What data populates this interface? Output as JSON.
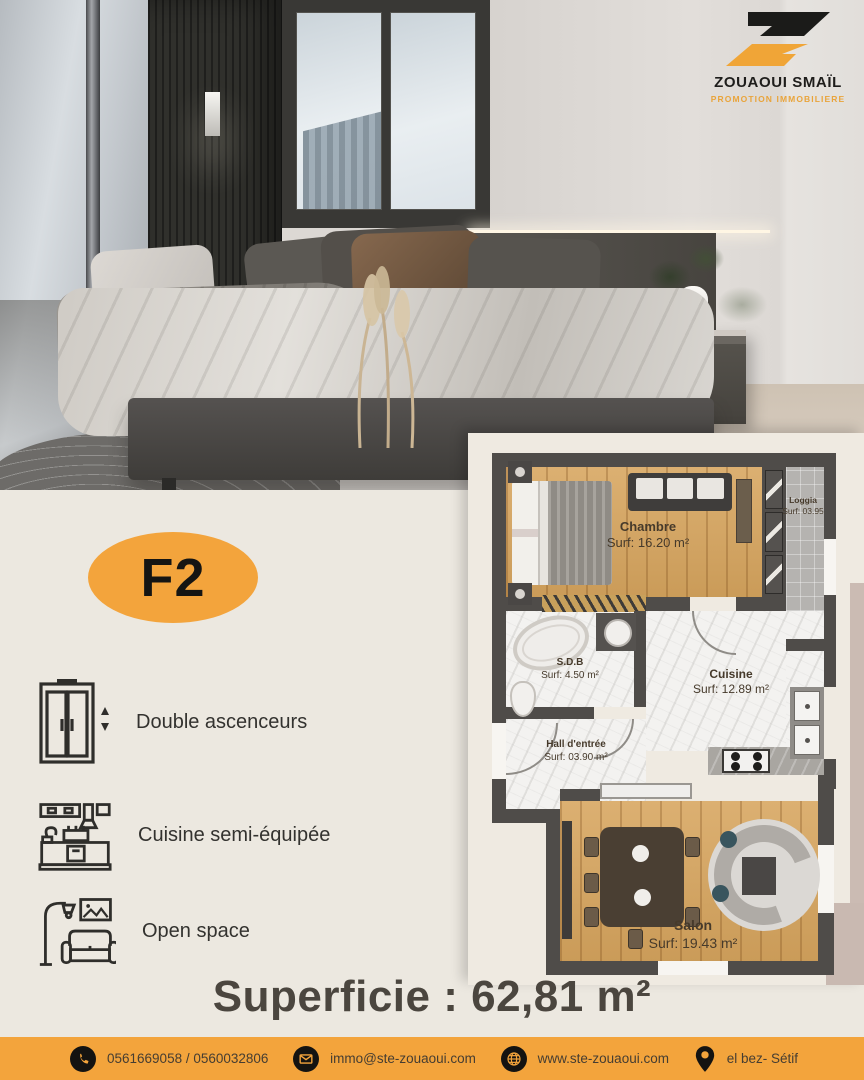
{
  "brand": {
    "name": "ZOUAOUI SMAÏL",
    "tagline": "PROMOTION IMMOBILIERE",
    "logo_icon": "z-parallelogram-logo"
  },
  "badge": {
    "label": "F2"
  },
  "features": [
    {
      "icon": "elevator-icon",
      "label": "Double ascenceurs"
    },
    {
      "icon": "kitchen-icon",
      "label": "Cuisine semi-équipée"
    },
    {
      "icon": "sofa-lamp-icon",
      "label": "Open space"
    }
  ],
  "plan": {
    "chambre": {
      "name": "Chambre",
      "surf": "Surf: 16.20 m²"
    },
    "loggia": {
      "name": "Loggia",
      "surf": "Surf: 03.95"
    },
    "sdb": {
      "name": "S.D.B",
      "surf": "Surf: 4.50 m²"
    },
    "cuisine": {
      "name": "Cuisine",
      "surf": "Surf: 12.89 m²"
    },
    "hall": {
      "name": "Hall d'entrée",
      "surf": "Surf: 03.90 m²"
    },
    "salon": {
      "name": "Salon",
      "surf": "Surf: 19.43 m²"
    }
  },
  "summary": {
    "superficie": "Superficie : 62,81 m²"
  },
  "footer": {
    "phone": {
      "icon": "phone-icon",
      "text": "0561669058 / 0560032806"
    },
    "email": {
      "icon": "envelope-icon",
      "text": "immo@ste-zouaoui.com"
    },
    "website": {
      "icon": "globe-icon",
      "text": "www.ste-zouaoui.com"
    },
    "location": {
      "icon": "location-pin-icon",
      "text": "el bez- Sétif"
    }
  },
  "colors": {
    "accent_orange": "#F3A43C",
    "footer_bar": "#F3A43C",
    "page_background": "#ECE8E0",
    "plan_wall": "#4F4C49",
    "plan_wood": "#D7A55E",
    "text_dark": "#4B463F"
  }
}
